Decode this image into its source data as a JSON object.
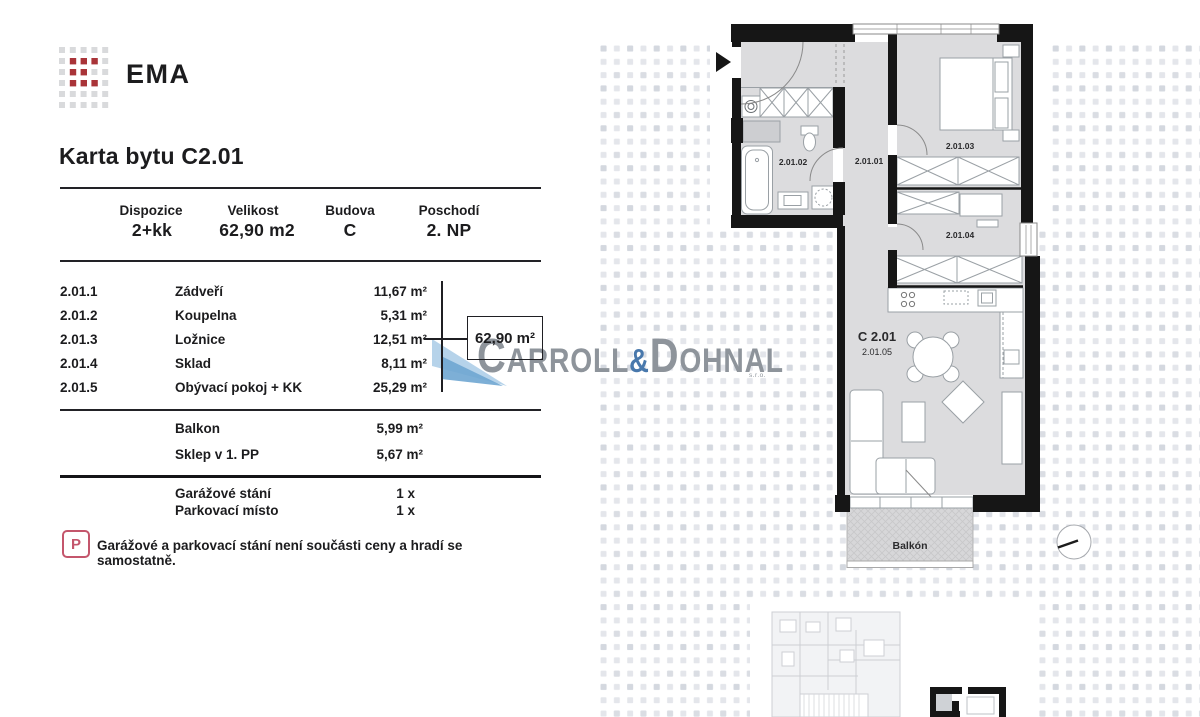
{
  "brand": {
    "logo_text": "EMA"
  },
  "title": "Karta bytu C2.01",
  "summary": {
    "columns": [
      {
        "label": "Dispozice",
        "value": "2+kk"
      },
      {
        "label": "Velikost",
        "value": "62,90 m2"
      },
      {
        "label": "Budova",
        "value": "C"
      },
      {
        "label": "Poschodí",
        "value": "2. NP"
      }
    ]
  },
  "rooms": [
    {
      "code": "2.01.1",
      "name": "Zádveří",
      "area": "11,67 m²"
    },
    {
      "code": "2.01.2",
      "name": "Koupelna",
      "area": "5,31 m²"
    },
    {
      "code": "2.01.3",
      "name": "Ložnice",
      "area": "12,51 m²"
    },
    {
      "code": "2.01.4",
      "name": "Sklad",
      "area": "8,11 m²"
    },
    {
      "code": "2.01.5",
      "name": "Obývací pokoj + KK",
      "area": "25,29 m²"
    }
  ],
  "total_area_callout": "62,90 m²",
  "extras": [
    {
      "name": "Balkon",
      "area": "5,99 m²"
    },
    {
      "name": "Sklep v 1. PP",
      "area": "5,67 m²"
    }
  ],
  "parking": [
    {
      "name": "Garážové stání",
      "count": "1 x"
    },
    {
      "name": "Parkovací místo",
      "count": "1 x"
    }
  ],
  "note": {
    "icon_letter": "P",
    "text": "Garážové a parkovací stání není součásti ceny a hradí se samostatně."
  },
  "watermark": {
    "p1_initial": "C",
    "p1_rest": "ARROLL",
    "amp": "&",
    "p2_initial": "D",
    "p2_rest": "OHNAL",
    "suffix": "s.r.o."
  },
  "floorplan": {
    "unit_label": "C 2.01",
    "room_ids": {
      "hall": "2.01.01",
      "bathroom": "2.01.02",
      "bedroom": "2.01.03",
      "storage": "2.01.04",
      "living": "2.01.05"
    },
    "balcony_label": "Balkón"
  },
  "colors": {
    "brand_red": "#a93439",
    "logo_gray": "#d9dadc",
    "wall": "#161616",
    "floor": "#dcdcde",
    "note_accent": "#c4566c",
    "watermark_gray": "#8e949b",
    "watermark_blue": "#4878ac"
  }
}
